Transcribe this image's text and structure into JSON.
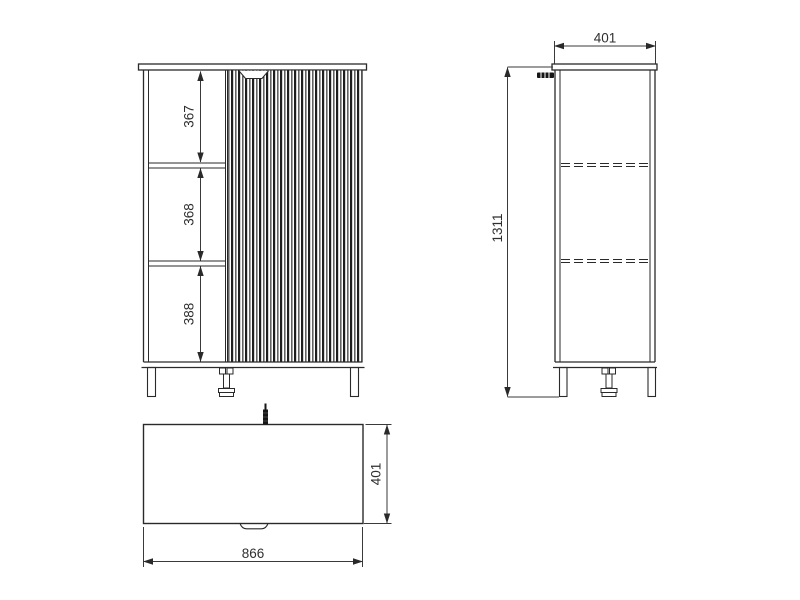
{
  "front_view": {
    "shelf_heights": [
      "367",
      "368",
      "388"
    ]
  },
  "side_view": {
    "depth": "401",
    "total_height": "1311"
  },
  "top_view": {
    "depth": "401",
    "width": "866"
  },
  "colors": {
    "line": "#2a2a2a",
    "dim_line": "#3a3a3a",
    "background": "#ffffff"
  }
}
